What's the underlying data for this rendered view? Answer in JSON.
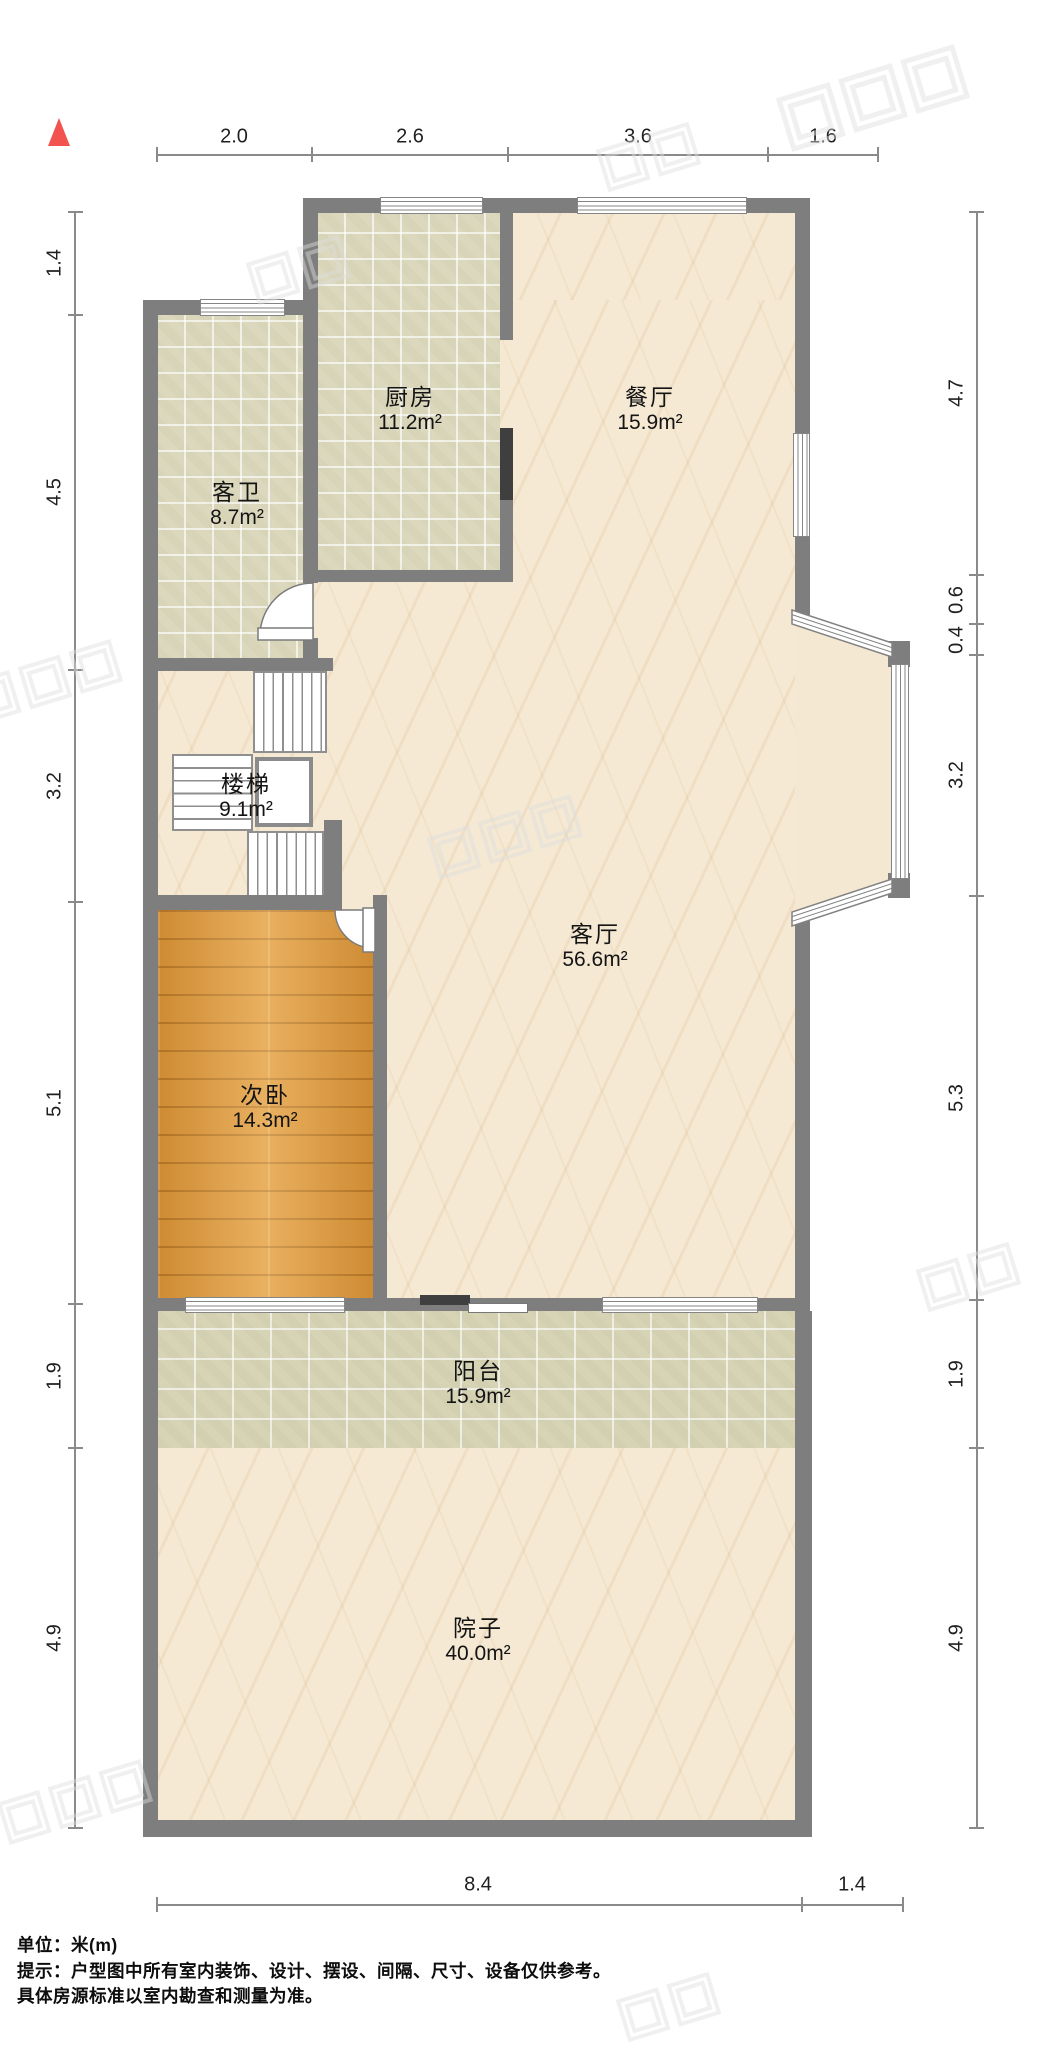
{
  "title": "户型图",
  "north_arrow": "north-arrow-icon",
  "colors": {
    "wall": "#7e7e7e",
    "wall_dark_frame": "#3f3f3f",
    "north_arrow_red": "#f2534f",
    "marble_floor": "#f5e9d4",
    "tile_floor": "#dbd8bd",
    "wood_floor": "#e19a3c",
    "dimension_line": "#8a8a8a",
    "text": "#141414"
  },
  "rooms": [
    {
      "id": "kitchen",
      "name": "厨房",
      "area": "11.2m²"
    },
    {
      "id": "dining",
      "name": "餐厅",
      "area": "15.9m²"
    },
    {
      "id": "bath",
      "name": "客卫",
      "area": "8.7m²"
    },
    {
      "id": "stairs",
      "name": "楼梯",
      "area": "9.1m²"
    },
    {
      "id": "living",
      "name": "客厅",
      "area": "56.6m²"
    },
    {
      "id": "bedroom",
      "name": "次卧",
      "area": "14.3m²"
    },
    {
      "id": "balcony",
      "name": "阳台",
      "area": "15.9m²"
    },
    {
      "id": "yard",
      "name": "院子",
      "area": "40.0m²"
    }
  ],
  "dimensions": {
    "top": [
      "2.0",
      "2.6",
      "3.6",
      "1.6"
    ],
    "left": [
      "1.4",
      "4.5",
      "3.2",
      "5.1",
      "1.9",
      "4.9"
    ],
    "right": [
      "4.7",
      "0.6",
      "0.4",
      "3.2",
      "5.3",
      "1.9",
      "4.9"
    ],
    "bottom": [
      "8.4",
      "1.4"
    ]
  },
  "footer": {
    "unit_line": "单位：米(m)",
    "tip_line1": "提示：户型图中所有室内装饰、设计、摆设、间隔、尺寸、设备仅供参考。",
    "tip_line2": "具体房源标准以室内勘查和测量为准。"
  }
}
